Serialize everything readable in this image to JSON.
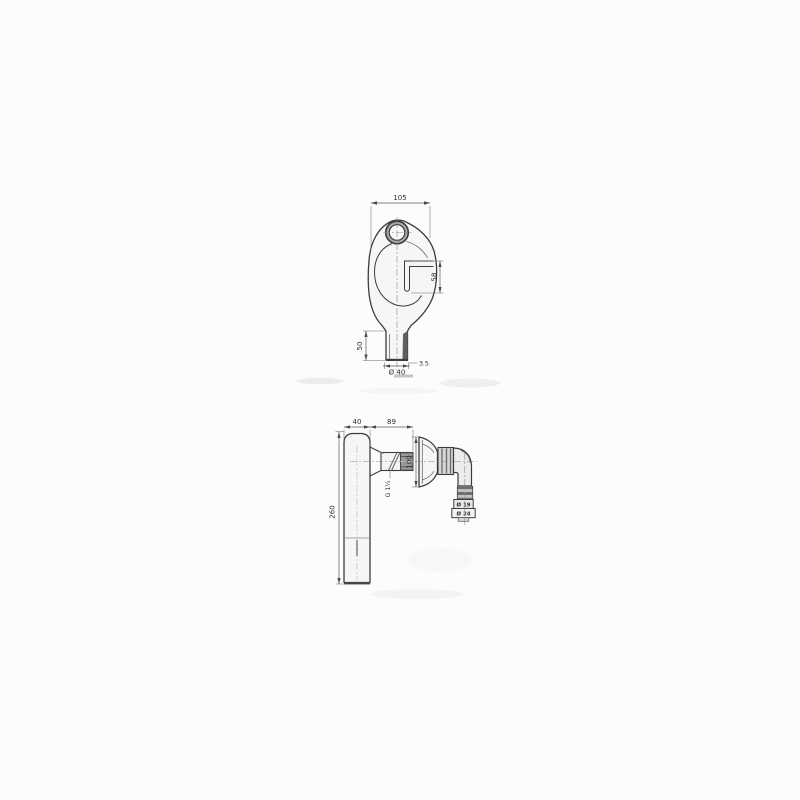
{
  "colors": {
    "background": "#fcfcfc",
    "line": "#3c3c3c",
    "dim_line": "#5a5a5a",
    "text": "#2f2f2f",
    "ring_shade": "#a8a8a8",
    "dark_shade": "#5f5f5f",
    "nut_shade": "#d6d6d6",
    "thread_shade": "#9a9a9a"
  },
  "top_view": {
    "dim_overall_width": "105",
    "dim_slot_depth": "58",
    "dim_outlet_length": "50",
    "dim_wall_thickness": "3.5",
    "dim_outlet_diameter": "Ø 40"
  },
  "side_view": {
    "dim_body_width": "40",
    "dim_inlet_length": "89",
    "dim_rosette_height": "100",
    "dim_thread": "G 1¼",
    "dim_body_height": "260",
    "dim_hose_step_small": "Ø 19",
    "dim_hose_step_large": "Ø 24"
  }
}
